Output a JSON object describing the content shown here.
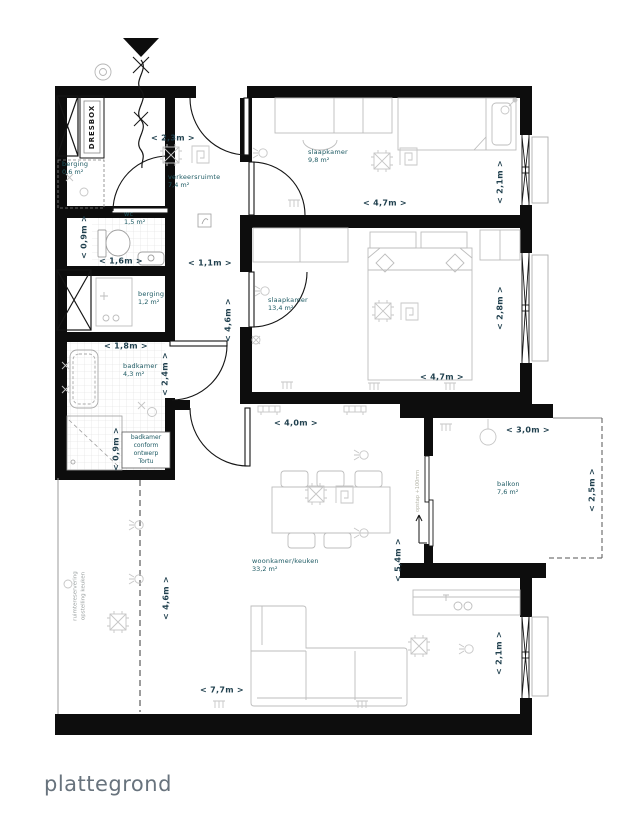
{
  "title": "plattegrond",
  "closet": {
    "label": "DRESBOX"
  },
  "rooms": {
    "storage_small": {
      "name": "berging",
      "area": "0,6 m²"
    },
    "hall": {
      "name": "verkeersruimte",
      "area": "7,4 m²"
    },
    "bedroom1": {
      "name": "slaapkamer",
      "area": "9,8 m²"
    },
    "wc": {
      "name": "wc",
      "area": "1,5 m²"
    },
    "storage": {
      "name": "berging",
      "area": "1,2 m²"
    },
    "bedroom2": {
      "name": "slaapkamer",
      "area": "13,4 m²"
    },
    "bathroom": {
      "name": "badkamer",
      "area": "4,3 m²"
    },
    "living": {
      "name": "woonkamer/keuken",
      "area": "33,2 m²"
    },
    "balcony": {
      "name": "balkon",
      "area": "7,6 m²"
    }
  },
  "notes": {
    "bathroom_note": "badkamer\nconform\nontwerp\nTortu",
    "kitchen_reservation": "ruimtereservering\nopstelling keuken",
    "balcony_step": "opstap +100mm"
  },
  "dimensions": {
    "entry_width": "< 2,3m >",
    "bedroom1_width": "< 4,7m >",
    "bedroom1_depth": "< 2,1m >",
    "hall_width": "< 1,1m >",
    "wc_width": "< 1,6m >",
    "wc_depth": "< 0,9m >",
    "hall_length": "< 4,6m >",
    "bathroom_width": "< 1,8m >",
    "bathroom_depth": "< 2,4m >",
    "shower_width": "< 0,9m >",
    "bedroom2_width": "< 4,7m >",
    "bedroom2_depth": "< 2,8m >",
    "living_top_width": "< 4,0m >",
    "balcony_width": "< 3,0m >",
    "balcony_depth": "< 2,5m >",
    "living_depth": "< 5,4m >",
    "kitchen_zone_depth": "< 4,6m >",
    "living_width": "< 7,7m >",
    "living_window_depth": "< 2,1m >"
  },
  "colors": {
    "wall": "#0d0d0d",
    "room_label": "#1d5a63",
    "dimension": "#1f3f4d",
    "furniture": "#bdbdbd",
    "title": "#68737d"
  }
}
